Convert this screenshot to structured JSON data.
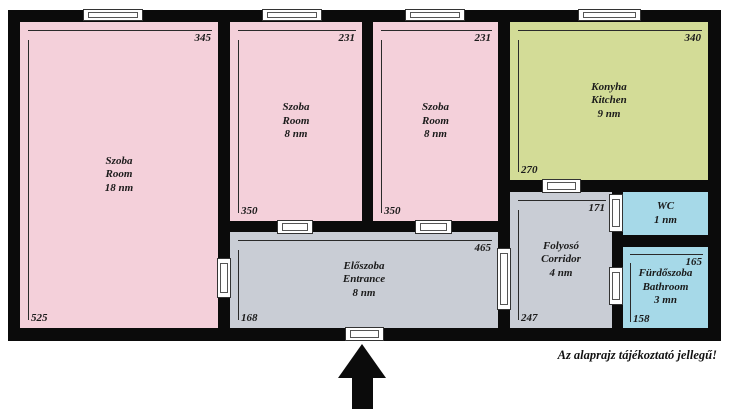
{
  "disclaimer": "Az alaprajz tájékoztató jellegű!",
  "colors": {
    "wall": "#0b0b0b",
    "room_pink": "#f4d0da",
    "kitchen_green": "#d3dc97",
    "wet_blue": "#a6d9e8",
    "hall_gray": "#c9cdd5"
  },
  "rooms": {
    "room_large": {
      "label_lines": [
        "Szoba",
        "Room",
        "18 nm"
      ],
      "dim_width": "345",
      "dim_height": "525"
    },
    "room_mid_left": {
      "label_lines": [
        "Szoba",
        "Room",
        "8 nm"
      ],
      "dim_width": "231",
      "dim_height": "350"
    },
    "room_mid_right": {
      "label_lines": [
        "Szoba",
        "Room",
        "8 nm"
      ],
      "dim_width": "231",
      "dim_height": "350"
    },
    "kitchen": {
      "label_lines": [
        "Konyha",
        "Kitchen",
        "9 nm"
      ],
      "dim_width": "340",
      "dim_height": "270"
    },
    "entrance": {
      "label_lines": [
        "Előszoba",
        "Entrance",
        "8 nm"
      ],
      "dim_width": "465",
      "dim_height": "168"
    },
    "corridor": {
      "label_lines": [
        "Folyosó",
        "Corridor",
        "4 nm"
      ],
      "dim_width": "171",
      "dim_height": "247"
    },
    "wc": {
      "label_lines": [
        "WC",
        "1 nm"
      ]
    },
    "bathroom": {
      "label_lines": [
        "Fürdőszoba",
        "Bathroom",
        "3 mn"
      ],
      "dim_width": "165",
      "dim_height": "158"
    }
  }
}
